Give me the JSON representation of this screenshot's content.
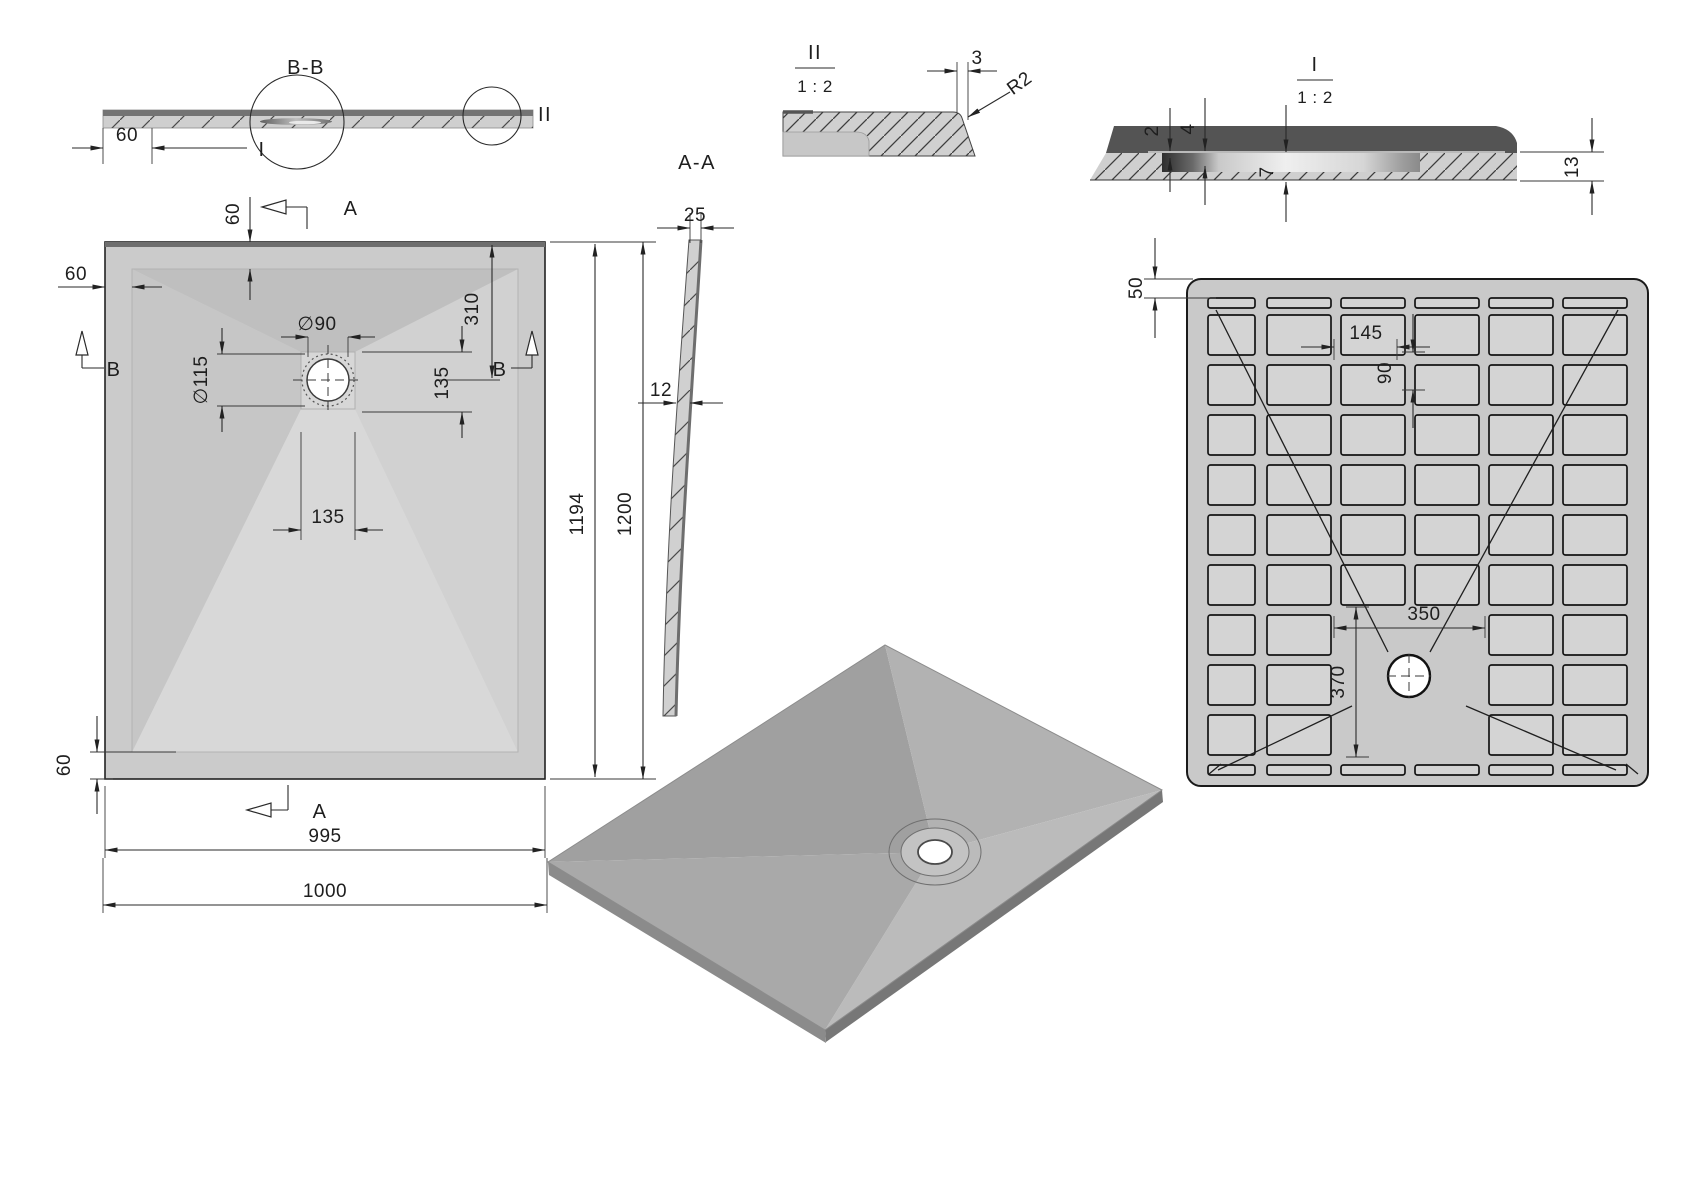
{
  "colors": {
    "background": "#ffffff",
    "line": "#2a2a2a",
    "tray_light": "#d3d3d3",
    "tray_mid": "#c7c7c7",
    "tray_dark_band": "#585858",
    "iso_grey": "#aaaaaa"
  },
  "labels": {
    "section_bb": {
      "title": "B-B",
      "detail_large_ref": "I",
      "detail_small_ref": "II",
      "dim_60": "60"
    },
    "plan": {
      "section_a": "A",
      "section_b": "B",
      "dim_60_top": "60",
      "dim_60_left": "60",
      "dim_60_bottom": "60",
      "dia_90": "∅90",
      "dia_115": "∅115",
      "dim_310": "310",
      "dim_135_right": "135",
      "dim_135_bottom": "135",
      "dim_1194": "1194",
      "dim_1200": "1200",
      "dim_995": "995",
      "dim_1000": "1000"
    },
    "section_aa": {
      "title": "A-A",
      "dim_25": "25",
      "dim_12": "12"
    },
    "detail_ii": {
      "title": "II",
      "scale": "1 : 2",
      "dim_3": "3",
      "radius": "R2"
    },
    "detail_i": {
      "title": "I",
      "scale": "1 : 2",
      "dim_2": "2",
      "dim_4": "4",
      "dim_7": "7",
      "dim_13": "13"
    },
    "bottom_view": {
      "dim_50": "50",
      "dim_145": "145",
      "dim_90": "90",
      "dim_350": "350",
      "dim_370": "370"
    }
  }
}
